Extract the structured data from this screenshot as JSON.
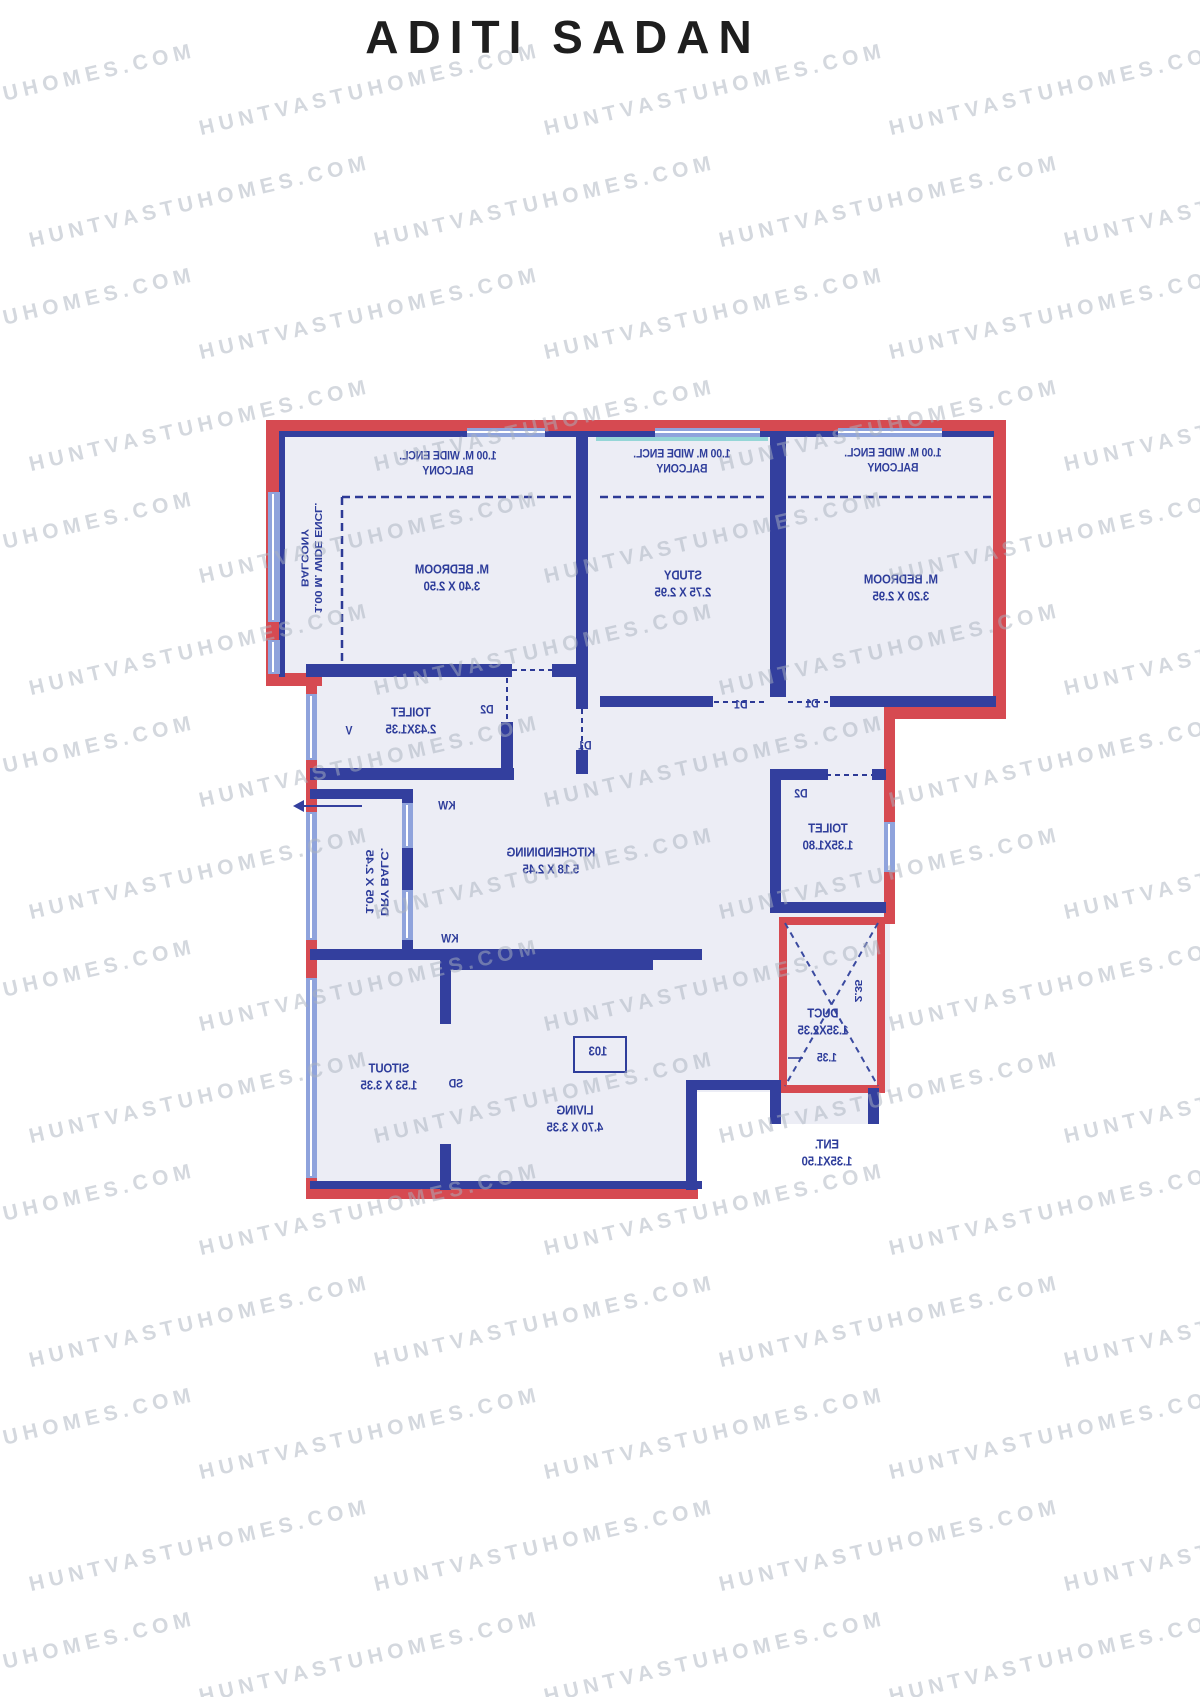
{
  "title": "ADITI SADAN",
  "watermark": {
    "text": "HUNTVASTUHOMES.COM"
  },
  "colors": {
    "wall_red": "#d64a51",
    "wall_blue": "#333f9e",
    "window_blue": "#8fa3dc",
    "room_fill": "#ecedf5",
    "label_blue": "#2e3d9b",
    "teal_accent": "#7fd0d0",
    "watermark_gray": "#aab2bf"
  },
  "plan": {
    "rooms": {
      "balcony_left": {
        "lines": [
          "1.00 M. WIDE ENCL.",
          "BALCONY"
        ]
      },
      "balcony_top_left": {
        "lines": [
          "1.00 M. WIDE ENCL.",
          "BALCONY"
        ]
      },
      "balcony_top_mid": {
        "lines": [
          "1.00 M. WIDE ENCL.",
          "BALCONY"
        ]
      },
      "balcony_top_right": {
        "lines": [
          "1.00 M. WIDE ENCL.",
          "BALCONY"
        ]
      },
      "master_bedroom_1": {
        "lines": [
          "M. BEDROOM",
          "3.40 X 2.50"
        ]
      },
      "study": {
        "lines": [
          "STUDY",
          "2.75 X 2.95"
        ]
      },
      "master_bedroom_2": {
        "lines": [
          "M. BEDROOM",
          "3.20 X 2.95"
        ]
      },
      "toilet_1": {
        "lines": [
          "TOILET",
          "2.43X1.35"
        ]
      },
      "kitchen_dining": {
        "lines": [
          "KITCHENDINING",
          "5.18 X 2.45"
        ]
      },
      "dry_balcony": {
        "lines": [
          "DRY BALC.",
          "1.05 X 2.45"
        ]
      },
      "sitout": {
        "lines": [
          "SITOUT",
          "1.53 X 3.35"
        ]
      },
      "living": {
        "lines": [
          "LIVING",
          "4.70 X 3.35"
        ]
      },
      "toilet_2": {
        "lines": [
          "TOILET",
          "1.35X1.80"
        ]
      },
      "duct": {
        "lines": [
          "DUCT",
          "1.35X2.35"
        ]
      },
      "entry": {
        "lines": [
          "ENT.",
          "1.35X1.50"
        ]
      }
    },
    "markers": {
      "door_d1_hall": "D1",
      "door_d1_study": "D1",
      "door_d1_bedroom2": "D1",
      "door_d2_toilet1": "D2",
      "door_d2_toilet2": "D2",
      "window_kw_top": "KW",
      "window_kw_bottom": "KW",
      "vent_v": "V",
      "sliding_door_sd": "SD",
      "unit_number": "103",
      "duct_depth": "2.35",
      "duct_width": "1.35"
    }
  }
}
